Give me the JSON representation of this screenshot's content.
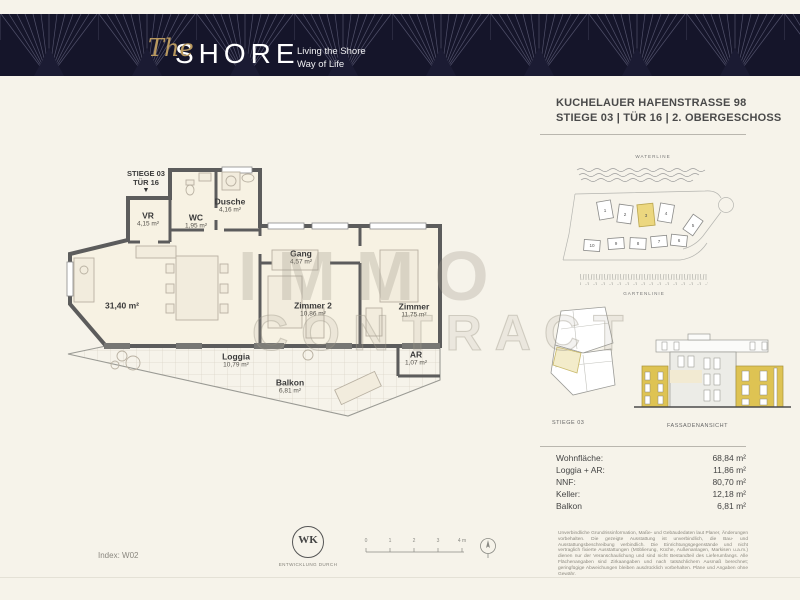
{
  "header": {
    "logo_script": "The",
    "logo_main": "SHORE",
    "tagline_line1": "Living the Shore",
    "tagline_line2": "Way of Life"
  },
  "address": {
    "line1": "KUCHELAUER HAFENSTRASSE 98",
    "line2": "STIEGE 03 | TÜR 16 | 2. OBERGESCHOSS"
  },
  "floorplan": {
    "entrance_line1": "STIEGE 03",
    "entrance_line2": "TÜR 16",
    "entrance_arrow": "▼",
    "rooms": {
      "vr": {
        "name": "VR",
        "area": "4,15 m²"
      },
      "wc": {
        "name": "WC",
        "area": "1,95 m²"
      },
      "dusche": {
        "name": "Dusche",
        "area": "4,16 m²"
      },
      "gang": {
        "name": "Gang",
        "area": "4,57 m²"
      },
      "wohnen": {
        "name": "",
        "area": "31,40 m²"
      },
      "zimmer2": {
        "name": "Zimmer 2",
        "area": "10,86 m²"
      },
      "zimmer": {
        "name": "Zimmer",
        "area": "11,75 m²"
      },
      "loggia": {
        "name": "Loggia",
        "area": "10,79 m²"
      },
      "ar": {
        "name": "AR",
        "area": "1,07 m²"
      },
      "balkon": {
        "name": "Balkon",
        "area": "6,81 m²"
      }
    },
    "watermark_line1": "IMMO",
    "watermark_line2": "CONTRACT"
  },
  "siteplan": {
    "waterline_label": "WATERLINE",
    "gartenline_label": "GARTENLINIE",
    "units_top": [
      "1",
      "2",
      "3",
      "4",
      "5"
    ],
    "units_bottom": [
      "10",
      "9",
      "8",
      "7",
      "6"
    ],
    "highlighted_unit": "3"
  },
  "keyplan": {
    "label": "STIEGE 03"
  },
  "elevation": {
    "label": "FASSADENANSICHT"
  },
  "areas_table": {
    "rows": [
      {
        "label": "Wohnfläche:",
        "value": "68,84 m²"
      },
      {
        "label": "Loggia + AR:",
        "value": "11,86 m²"
      },
      {
        "label": "NNF:",
        "value": "80,70 m²"
      },
      {
        "label": "Keller:",
        "value": "12,18 m²"
      },
      {
        "label": "Balkon",
        "value": "6,81 m²"
      }
    ]
  },
  "footer": {
    "index_label": "Index: W02",
    "wk_logo": "WK",
    "developer_label": "ENTWICKLUNG DURCH",
    "scale_ticks": [
      "0",
      "1",
      "2",
      "3",
      "4 m"
    ],
    "disclaimer": "Unverbindliche Grundrissinformation, Maße- und Gebäudedaten laut Planer, Änderungen vorbehalten. Die gezeigte Ausstattung ist unverbindlich, die Bau- und Ausstattungsbeschreibung verbindlich. Die Einrichtungsgegenstände und nicht vertraglich fixierte Ausstattungen (Möblierung, Küche, Außenanlagen, Markisen u.a.m.) dienen nur der Veranschaulichung und sind nicht Bestandteil des Lieferumfangs. Alle Flächenangaben sind Zirkaangaben und nach tatsächlichem Ausmaß berechnet; geringfügige Abweichungen bleiben ausdrücklich vorbehalten. Pläne und Angaben ohne Gewähr."
  }
}
